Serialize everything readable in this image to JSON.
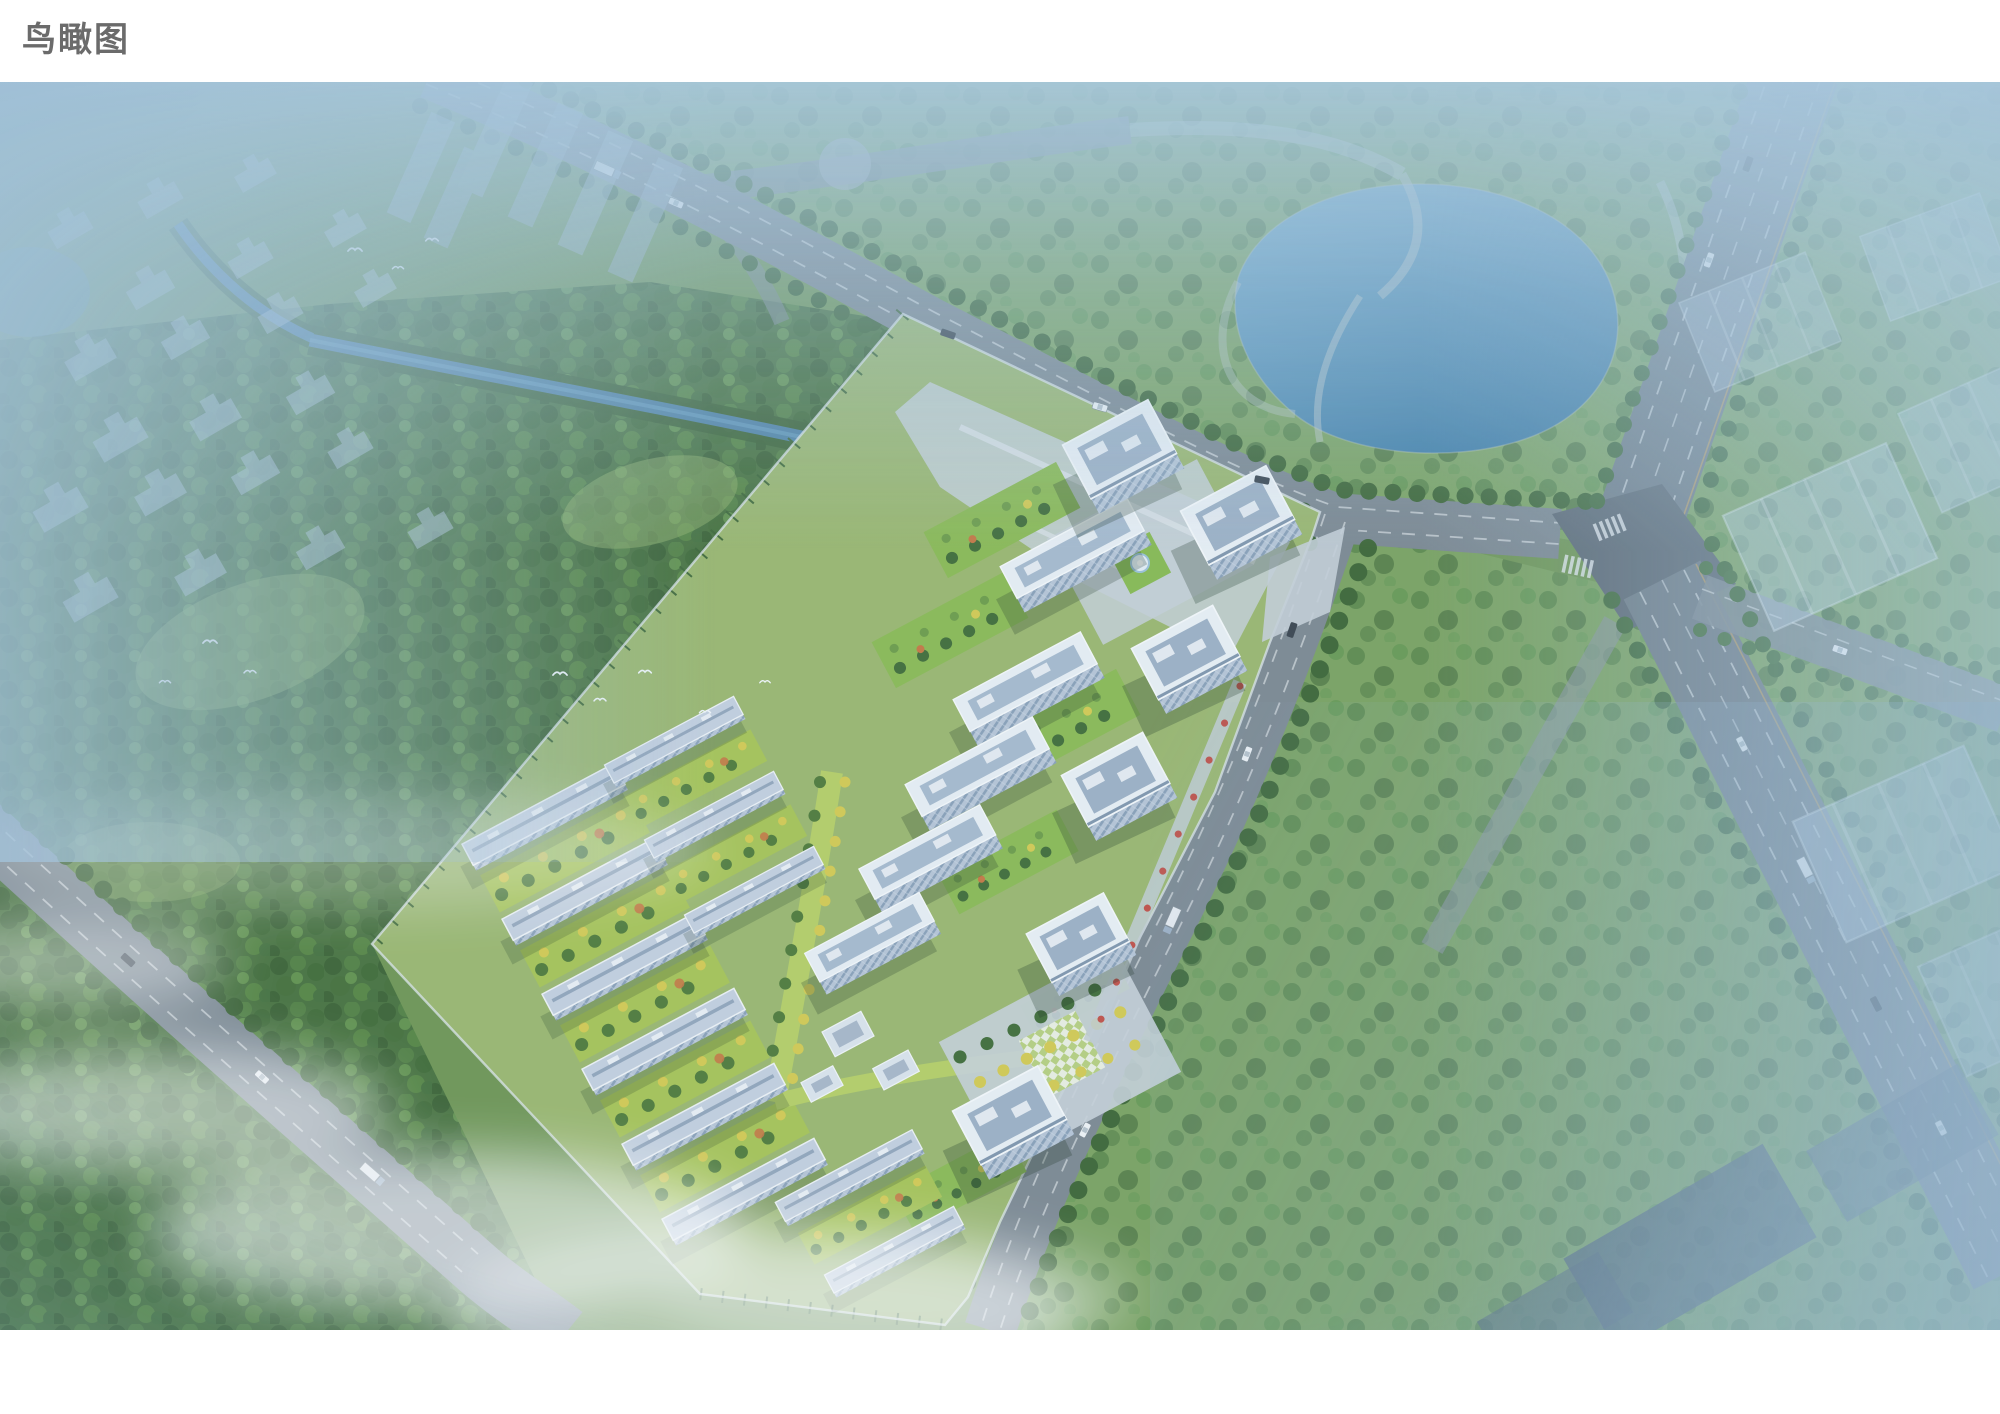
{
  "page": {
    "title": "鸟瞰图",
    "background": "#ffffff"
  },
  "figure": {
    "type": "architectural-aerial-rendering",
    "subject": "residential-community-birds-eye-view",
    "palette": {
      "title": "#6b6b6b",
      "hazeBlue": "#a8c3d6",
      "forest": "#47713a",
      "parkGreen": "#7ca45f",
      "lawn": "#a9c653",
      "water": "#4f8fb5",
      "canal": "#4e81a4",
      "road": "#7d8890",
      "intersection": "#5c6771",
      "building": "#eef3f7",
      "roofInset": "#9fb2c6",
      "facade": "#b9c7d7",
      "accentYellow": "#d7cc4f",
      "accentOrange": "#c9763f",
      "accentRed": "#c4473d",
      "mist": "#ffffff"
    }
  }
}
